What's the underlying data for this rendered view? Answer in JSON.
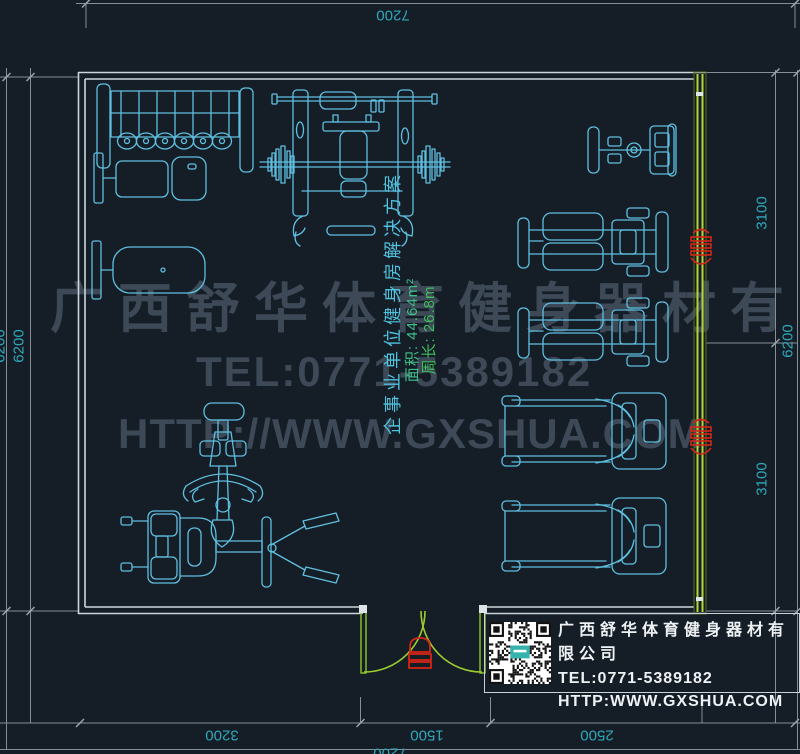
{
  "colors": {
    "background": "#151d27",
    "equipment_line": "#5fc0e0",
    "wall_light": "#ccd5da",
    "wall_green": "#b5d438",
    "door_green": "#9ccd2e",
    "dimension_line": "#858f96",
    "dimension_text": "#2fa9ba",
    "watermark": "#3d4956",
    "annotation_title": "#4fc2de",
    "annotation_stats": "#3fbf72",
    "red_marker": "#d42616",
    "info_text": "#eef2f4"
  },
  "dimensions": {
    "top": "7200",
    "left_outer": "6200",
    "left_inner": "6200",
    "right_upper": "3100",
    "right_lower": "3100",
    "right_total": "6200",
    "bottom_left": "3200",
    "bottom_middle": "1500",
    "bottom_right": "2500",
    "bottom_total": "7200"
  },
  "annotation": {
    "title": "企事业单位健身房解决方案",
    "area": "面积: 44.64m²",
    "perimeter": "周长: 26.8m"
  },
  "watermark": {
    "company": "广西舒华体育健身器材有限公司",
    "tel": "TEL:0771-5389182",
    "url": "HTTP://WWW.GXSHUA.COM"
  },
  "info_box": {
    "company": "广西舒华体育健身器材有限公司",
    "tel": "TEL:0771-5389182",
    "url": "HTTP:WWW.GXSHUA.COM"
  },
  "equipment": [
    {
      "name": "dumbbell-rack"
    },
    {
      "name": "flat-bench"
    },
    {
      "name": "utility-bench"
    },
    {
      "name": "bench-press-station"
    },
    {
      "name": "elliptical-trainer"
    },
    {
      "name": "strength-machine-upper"
    },
    {
      "name": "strength-machine-lower"
    },
    {
      "name": "treadmill-upper"
    },
    {
      "name": "treadmill-lower"
    },
    {
      "name": "upright-bike"
    },
    {
      "name": "leg-press-machine"
    }
  ]
}
